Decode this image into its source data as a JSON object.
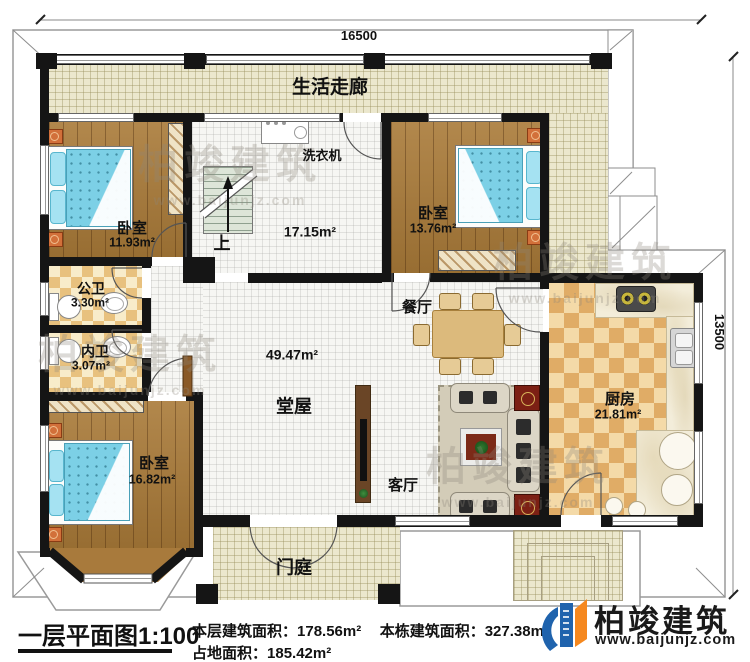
{
  "plan": {
    "dimensions": {
      "top": "16500",
      "right": "13500"
    },
    "rooms": {
      "corridor": {
        "name": "生活走廊"
      },
      "laundry": {
        "appliance": "洗衣机",
        "area": "17.15m²",
        "stairs_up": "上"
      },
      "bedroom_top_left": {
        "name": "卧室",
        "area": "11.93m²"
      },
      "bedroom_top_right": {
        "name": "卧室",
        "area": "13.76m²"
      },
      "bedroom_bottom_left": {
        "name": "卧室",
        "area": "16.82m²"
      },
      "public_bath": {
        "name": "公卫",
        "area": "3.30m²"
      },
      "inner_bath": {
        "name": "内卫",
        "area": "3.07m²"
      },
      "hall": {
        "name": "堂屋",
        "area": "49.47m²"
      },
      "dining": {
        "name": "餐厅"
      },
      "living": {
        "name": "客厅"
      },
      "kitchen": {
        "name": "厨房",
        "area": "21.81m²"
      },
      "porch": {
        "name": "门庭"
      }
    }
  },
  "footer": {
    "title": "一层平面图1:100",
    "stats": [
      {
        "label": "本层建筑面积：",
        "value": "178.56m²"
      },
      {
        "label": "本栋建筑面积：",
        "value": "327.38m²"
      },
      {
        "label": "占地面积：",
        "value": "185.42m²"
      }
    ],
    "brand": {
      "name": "柏竣建筑",
      "url": "www.baijunjz.com"
    }
  },
  "watermark": {
    "name": "柏竣建筑",
    "url": "www.baijunjz.com"
  }
}
